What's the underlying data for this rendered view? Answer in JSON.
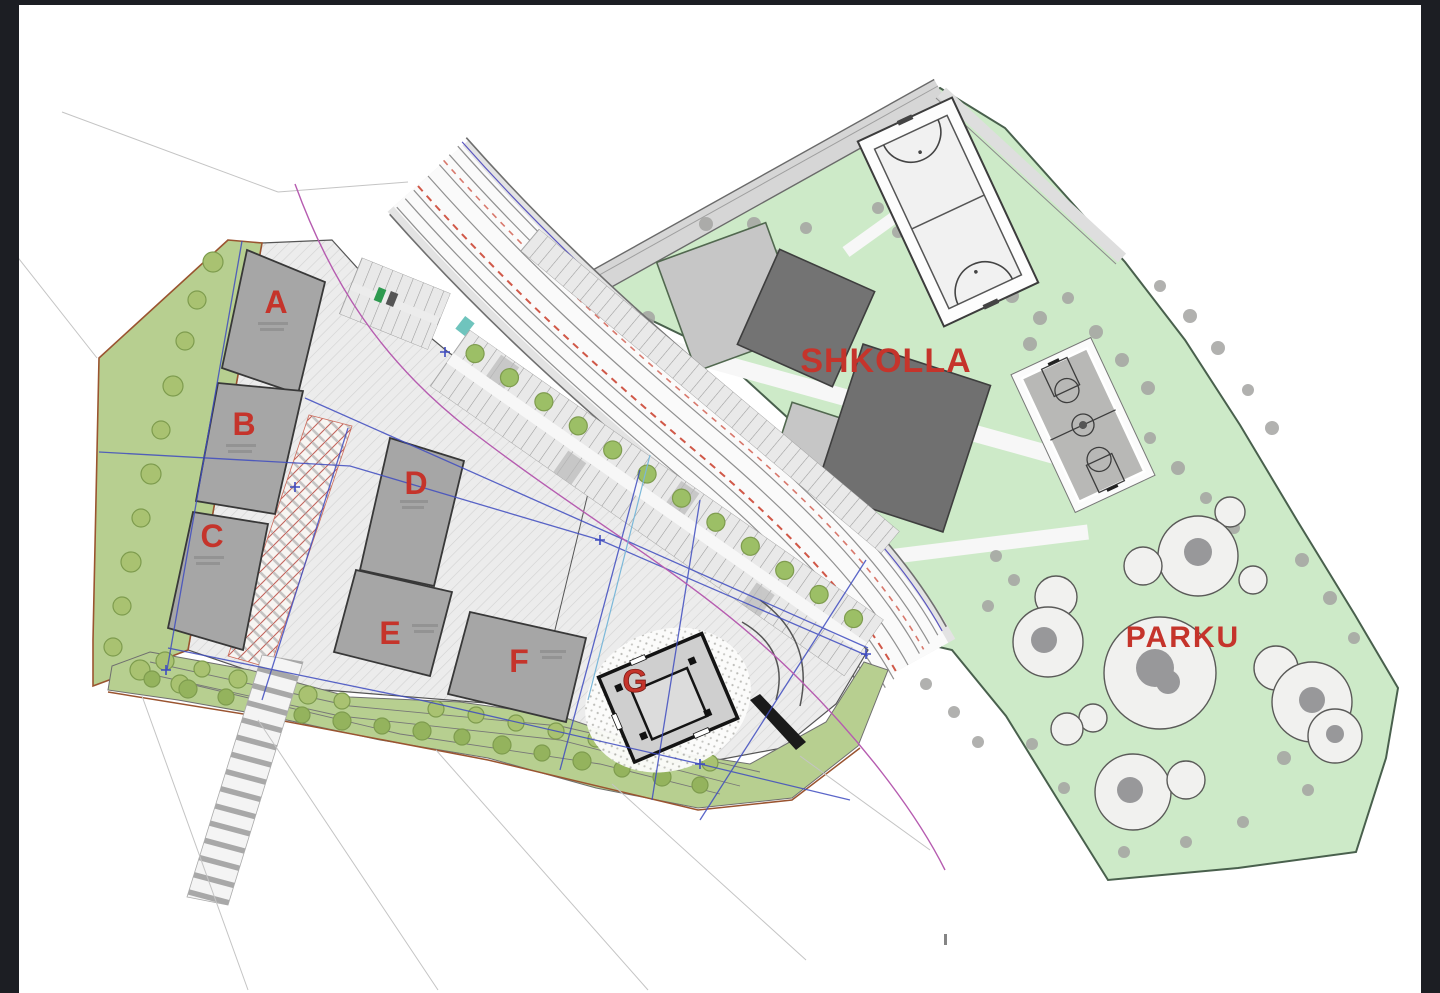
{
  "window": {
    "letterbox_color": "#1c1e23",
    "canvas_color": "#ffffff"
  },
  "plan": {
    "buildings": {
      "a": "A",
      "b": "B",
      "c": "C",
      "d": "D",
      "e": "E",
      "f": "F",
      "g": "G"
    },
    "zones": {
      "school": "SHKOLLA",
      "park": "PARKU"
    },
    "colors": {
      "label_red": "#c5342b",
      "site_green": "#b7cf90",
      "zone_green": "#cdeac8",
      "building_gray": "#a6a6a6",
      "school_building_dark": "#707070",
      "school_building_light": "#c6c6c6",
      "boundary_sienna": "#9a5430",
      "line_blue": "#3f4cc0",
      "line_magenta": "#b65cb0",
      "line_red_dashed": "#d05848"
    }
  }
}
